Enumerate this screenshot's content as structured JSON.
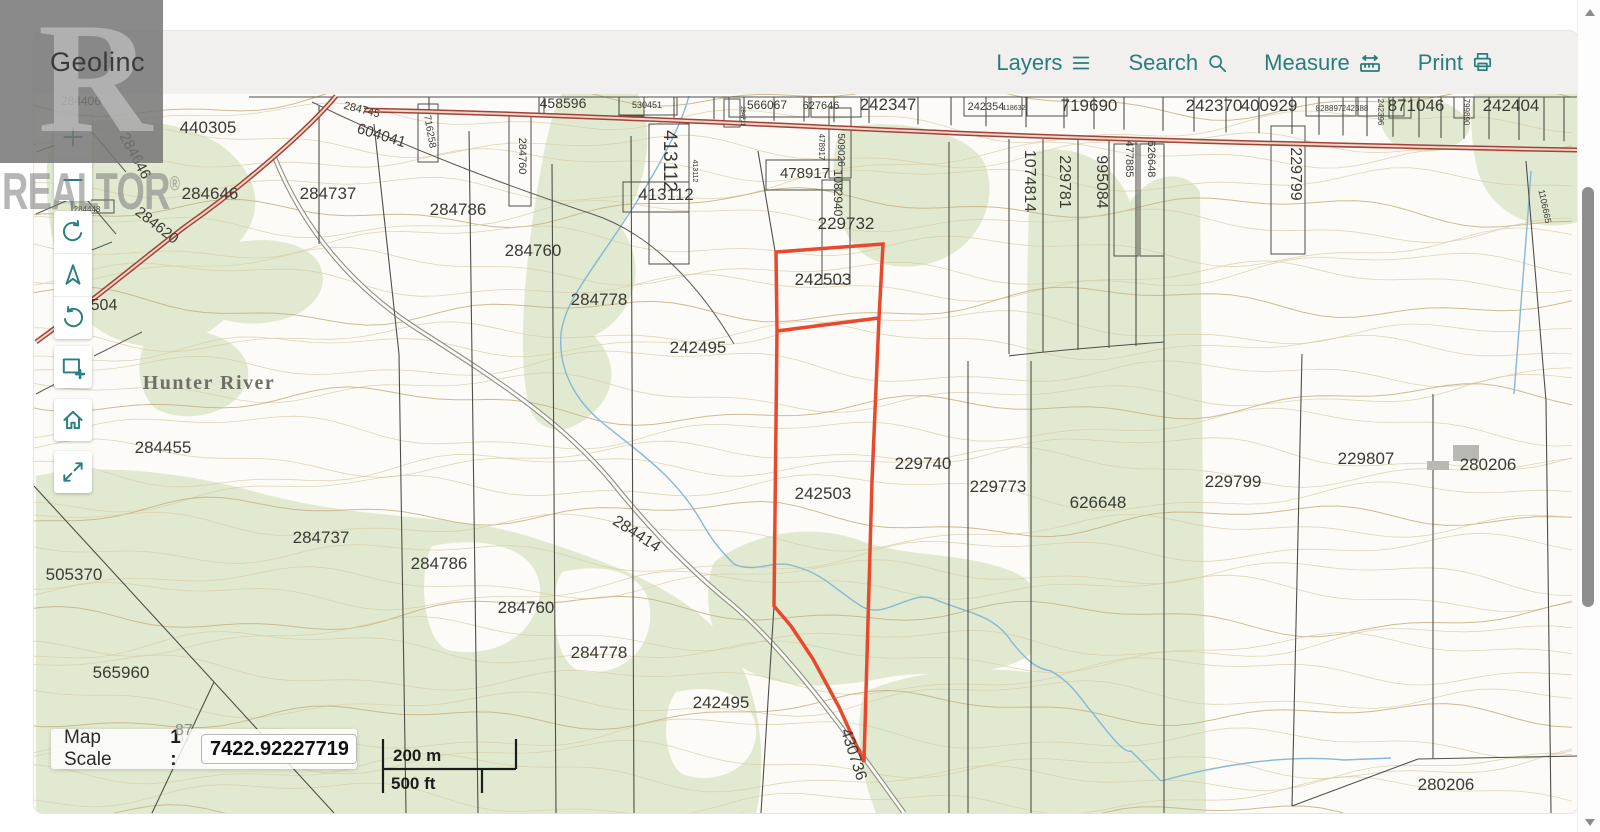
{
  "header": {
    "app_name": "Geolinc",
    "menu": [
      {
        "label": "Layers",
        "icon": "list-icon"
      },
      {
        "label": "Search",
        "icon": "search-icon"
      },
      {
        "label": "Measure",
        "icon": "ruler-icon"
      },
      {
        "label": "Print",
        "icon": "printer-icon"
      }
    ]
  },
  "watermark": {
    "letter": "R",
    "text": "REALTOR",
    "mark": "®"
  },
  "toolbar": {
    "buttons": [
      "zoom-in",
      "zoom-out",
      "rotate-clockwise",
      "north-arrow",
      "rotate-counterclockwise",
      "zoom-box",
      "home",
      "fullscreen"
    ]
  },
  "scale_panel": {
    "label": "Map Scale",
    "prefix": "1 :",
    "value": "7422.92227719"
  },
  "scale_bar": {
    "metric": "200 m",
    "imperial": "500 ft"
  },
  "map": {
    "place_name": "Hunter River",
    "highlight_parcel": {
      "color": "#e7492d",
      "stroke_width": 3.5,
      "label": "242503",
      "outer": [
        [
          775,
          251
        ],
        [
          882,
          243
        ],
        [
          878,
          317
        ],
        [
          871,
          480
        ],
        [
          863,
          761
        ],
        [
          838,
          706
        ],
        [
          812,
          658
        ],
        [
          790,
          625
        ],
        [
          773,
          605
        ],
        [
          776,
          330
        ]
      ],
      "divider": [
        [
          776,
          330
        ],
        [
          878,
          317
        ]
      ]
    },
    "labels": [
      {
        "t": "284406",
        "x": 80,
        "y": 104,
        "s": 12
      },
      {
        "t": "89",
        "x": 16,
        "y": 150,
        "s": 15
      },
      {
        "t": "284646",
        "x": 130,
        "y": 157,
        "s": 15,
        "r": 62
      },
      {
        "t": "284448",
        "x": 86,
        "y": 211,
        "s": 8
      },
      {
        "t": "284620",
        "x": 153,
        "y": 228,
        "s": 15,
        "r": 38
      },
      {
        "t": "504",
        "x": 103,
        "y": 309,
        "s": 16
      },
      {
        "t": "440305",
        "x": 207,
        "y": 132,
        "s": 17
      },
      {
        "t": "284646",
        "x": 209,
        "y": 198,
        "s": 17
      },
      {
        "t": "284737",
        "x": 327,
        "y": 198,
        "s": 17
      },
      {
        "t": "284745",
        "x": 360,
        "y": 112,
        "s": 11,
        "r": 14
      },
      {
        "t": "604041",
        "x": 379,
        "y": 139,
        "s": 15,
        "r": 17
      },
      {
        "t": "716258",
        "x": 426,
        "y": 131,
        "s": 10,
        "r": 80
      },
      {
        "t": "458596",
        "x": 562,
        "y": 107,
        "s": 14
      },
      {
        "t": "530451",
        "x": 646,
        "y": 107,
        "s": 9
      },
      {
        "t": "566067",
        "x": 766,
        "y": 108,
        "s": 12
      },
      {
        "t": "627646",
        "x": 820,
        "y": 108,
        "s": 11
      },
      {
        "t": "242347",
        "x": 887,
        "y": 109,
        "s": 17
      },
      {
        "t": "242354",
        "x": 985,
        "y": 109,
        "s": 11
      },
      {
        "t": "118632",
        "x": 1013,
        "y": 109,
        "s": 7
      },
      {
        "t": "719690",
        "x": 1088,
        "y": 110,
        "s": 17
      },
      {
        "t": "242370",
        "x": 1213,
        "y": 110,
        "s": 17
      },
      {
        "t": "400929",
        "x": 1268,
        "y": 110,
        "s": 17
      },
      {
        "t": "828897",
        "x": 1328,
        "y": 110,
        "s": 8
      },
      {
        "t": "242388",
        "x": 1354,
        "y": 110,
        "s": 8
      },
      {
        "t": "242396",
        "x": 1377,
        "y": 111,
        "s": 8,
        "r": 90
      },
      {
        "t": "871046",
        "x": 1415,
        "y": 110,
        "s": 17
      },
      {
        "t": "799890",
        "x": 1463,
        "y": 111,
        "s": 8,
        "r": 90
      },
      {
        "t": "242404",
        "x": 1510,
        "y": 110,
        "s": 17
      },
      {
        "t": "284760",
        "x": 518,
        "y": 155,
        "s": 11,
        "r": 90
      },
      {
        "t": "284711",
        "x": 740,
        "y": 115,
        "s": 6,
        "r": 90
      },
      {
        "t": "413112",
        "x": 663,
        "y": 160,
        "s": 19,
        "r": 90
      },
      {
        "t": "413112",
        "x": 692,
        "y": 170,
        "s": 7,
        "r": 90
      },
      {
        "t": "413112",
        "x": 665,
        "y": 199,
        "s": 17
      },
      {
        "t": "478917",
        "x": 818,
        "y": 146,
        "s": 8,
        "r": 90
      },
      {
        "t": "509026",
        "x": 837,
        "y": 149,
        "s": 10,
        "r": 90
      },
      {
        "t": "478917",
        "x": 804,
        "y": 177,
        "s": 15
      },
      {
        "t": "1082940",
        "x": 833,
        "y": 192,
        "s": 12,
        "r": 90
      },
      {
        "t": "229732",
        "x": 845,
        "y": 228,
        "s": 17
      },
      {
        "t": "1074814",
        "x": 1024,
        "y": 180,
        "s": 16,
        "r": 90
      },
      {
        "t": "229781",
        "x": 1059,
        "y": 181,
        "s": 16,
        "r": 90
      },
      {
        "t": "995084",
        "x": 1096,
        "y": 181,
        "s": 16,
        "r": 90
      },
      {
        "t": "477885",
        "x": 1125,
        "y": 158,
        "s": 11,
        "r": 90
      },
      {
        "t": "626648",
        "x": 1147,
        "y": 158,
        "s": 11,
        "r": 90
      },
      {
        "t": "229799",
        "x": 1290,
        "y": 173,
        "s": 16,
        "r": 90
      },
      {
        "t": "1106665",
        "x": 1541,
        "y": 206,
        "s": 9,
        "r": 78
      },
      {
        "t": "242503",
        "x": 822,
        "y": 284,
        "s": 17
      },
      {
        "t": "242495",
        "x": 697,
        "y": 352,
        "s": 17
      },
      {
        "t": "242503",
        "x": 822,
        "y": 498,
        "s": 17
      },
      {
        "t": "229740",
        "x": 922,
        "y": 468,
        "s": 17
      },
      {
        "t": "229773",
        "x": 997,
        "y": 491,
        "s": 17
      },
      {
        "t": "626648",
        "x": 1097,
        "y": 507,
        "s": 17
      },
      {
        "t": "229799",
        "x": 1232,
        "y": 486,
        "s": 17
      },
      {
        "t": "229807",
        "x": 1365,
        "y": 463,
        "s": 17
      },
      {
        "t": "280206",
        "x": 1487,
        "y": 469,
        "s": 17
      },
      {
        "t": "284786",
        "x": 457,
        "y": 214,
        "s": 17
      },
      {
        "t": "284760",
        "x": 532,
        "y": 255,
        "s": 17
      },
      {
        "t": "284778",
        "x": 598,
        "y": 304,
        "s": 17
      },
      {
        "t": "284455",
        "x": 162,
        "y": 452,
        "s": 17
      },
      {
        "t": "284737",
        "x": 320,
        "y": 542,
        "s": 17
      },
      {
        "t": "505370",
        "x": 73,
        "y": 579,
        "s": 17
      },
      {
        "t": "565960",
        "x": 120,
        "y": 677,
        "s": 17
      },
      {
        "t": "284786",
        "x": 438,
        "y": 568,
        "s": 17
      },
      {
        "t": "284760",
        "x": 525,
        "y": 612,
        "s": 17
      },
      {
        "t": "284778",
        "x": 598,
        "y": 657,
        "s": 17
      },
      {
        "t": "242495",
        "x": 720,
        "y": 707,
        "s": 17
      },
      {
        "t": "284414",
        "x": 633,
        "y": 537,
        "s": 16,
        "r": 33
      },
      {
        "t": "430736",
        "x": 848,
        "y": 755,
        "s": 16,
        "r": 72
      },
      {
        "t": "280206",
        "x": 1445,
        "y": 789,
        "s": 17
      },
      {
        "t": "87",
        "x": 183,
        "y": 740,
        "s": 15,
        "c": "g"
      }
    ]
  }
}
